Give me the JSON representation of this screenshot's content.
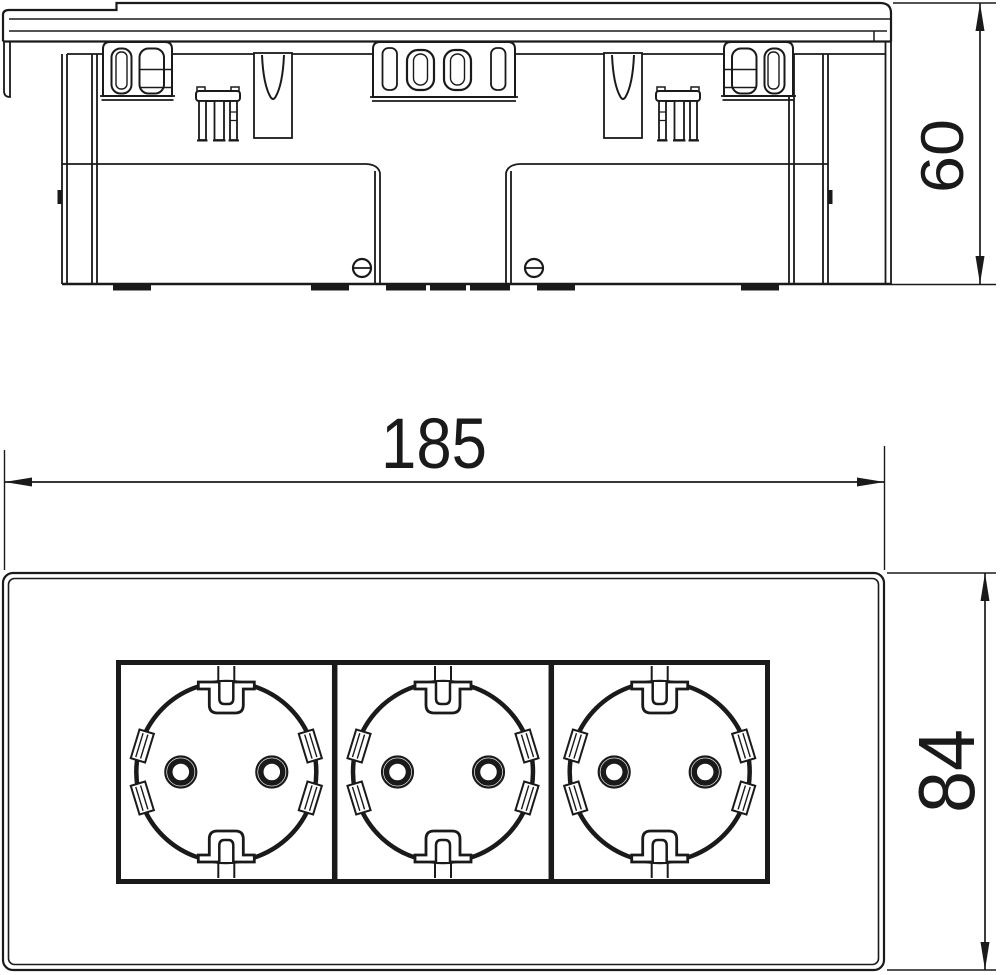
{
  "document": {
    "type": "technical-dimensional-drawing",
    "subject": "Triple socket outlet insert, side and front elevation",
    "background_color": "#ffffff",
    "line_color": "#1a1a1a"
  },
  "views": {
    "side_view": {
      "name": "side elevation",
      "features": [
        "cover plate",
        "snap-in latches",
        "spring pins",
        "two housing bodies",
        "two slotted screws",
        "mounting feet"
      ]
    },
    "front_view": {
      "name": "front elevation",
      "socket_count": 3,
      "socket_type": "schuko",
      "pin_holes_per_socket": 2,
      "features": [
        "frame plate",
        "three socket modules",
        "earth clips top and bottom",
        "side guide notches"
      ]
    }
  },
  "dimensions": {
    "width": {
      "label": "185",
      "orientation": "horizontal",
      "applies_to": "front view overall width"
    },
    "height": {
      "label": "84",
      "orientation": "vertical-rotated",
      "applies_to": "front view overall height"
    },
    "depth": {
      "label": "60",
      "orientation": "vertical-rotated",
      "applies_to": "side view overall depth"
    }
  }
}
